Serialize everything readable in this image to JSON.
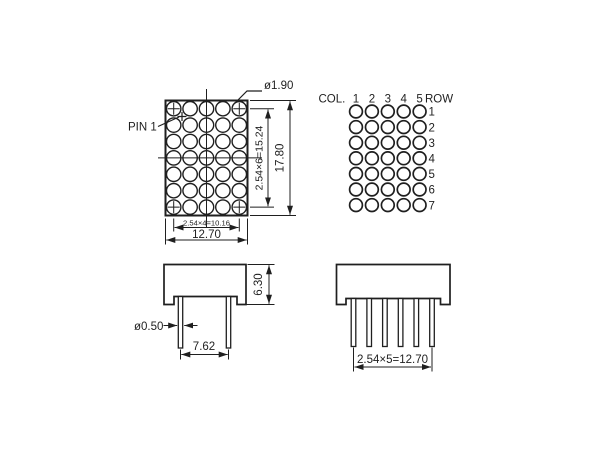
{
  "drawing": {
    "colors": {
      "line": "#1f1f1f",
      "background": "#ffffff"
    }
  },
  "front_view": {
    "pin1_label": "PIN 1",
    "dot_diameter_label": "ø1.90",
    "dim_row_pitch": "2.54×6=15.24",
    "dim_height": "17.80",
    "dim_col_pitch": "2.54×4=10.16",
    "dim_width": "12.70",
    "columns": 5,
    "rows": 7
  },
  "pin_map": {
    "col_header": "COL.",
    "row_header": "ROW",
    "column_numbers": [
      "1",
      "2",
      "3",
      "4",
      "5"
    ],
    "row_numbers": [
      "1",
      "2",
      "3",
      "4",
      "5",
      "6",
      "7"
    ]
  },
  "side_view_front": {
    "dim_body_height": "6.30",
    "dim_pin_diameter": "ø0.50",
    "dim_pin_spacing": "7.62",
    "pin_count": 2
  },
  "side_view_side": {
    "dim_pin_pitch": "2.54×5=12.70",
    "pin_count": 6
  }
}
